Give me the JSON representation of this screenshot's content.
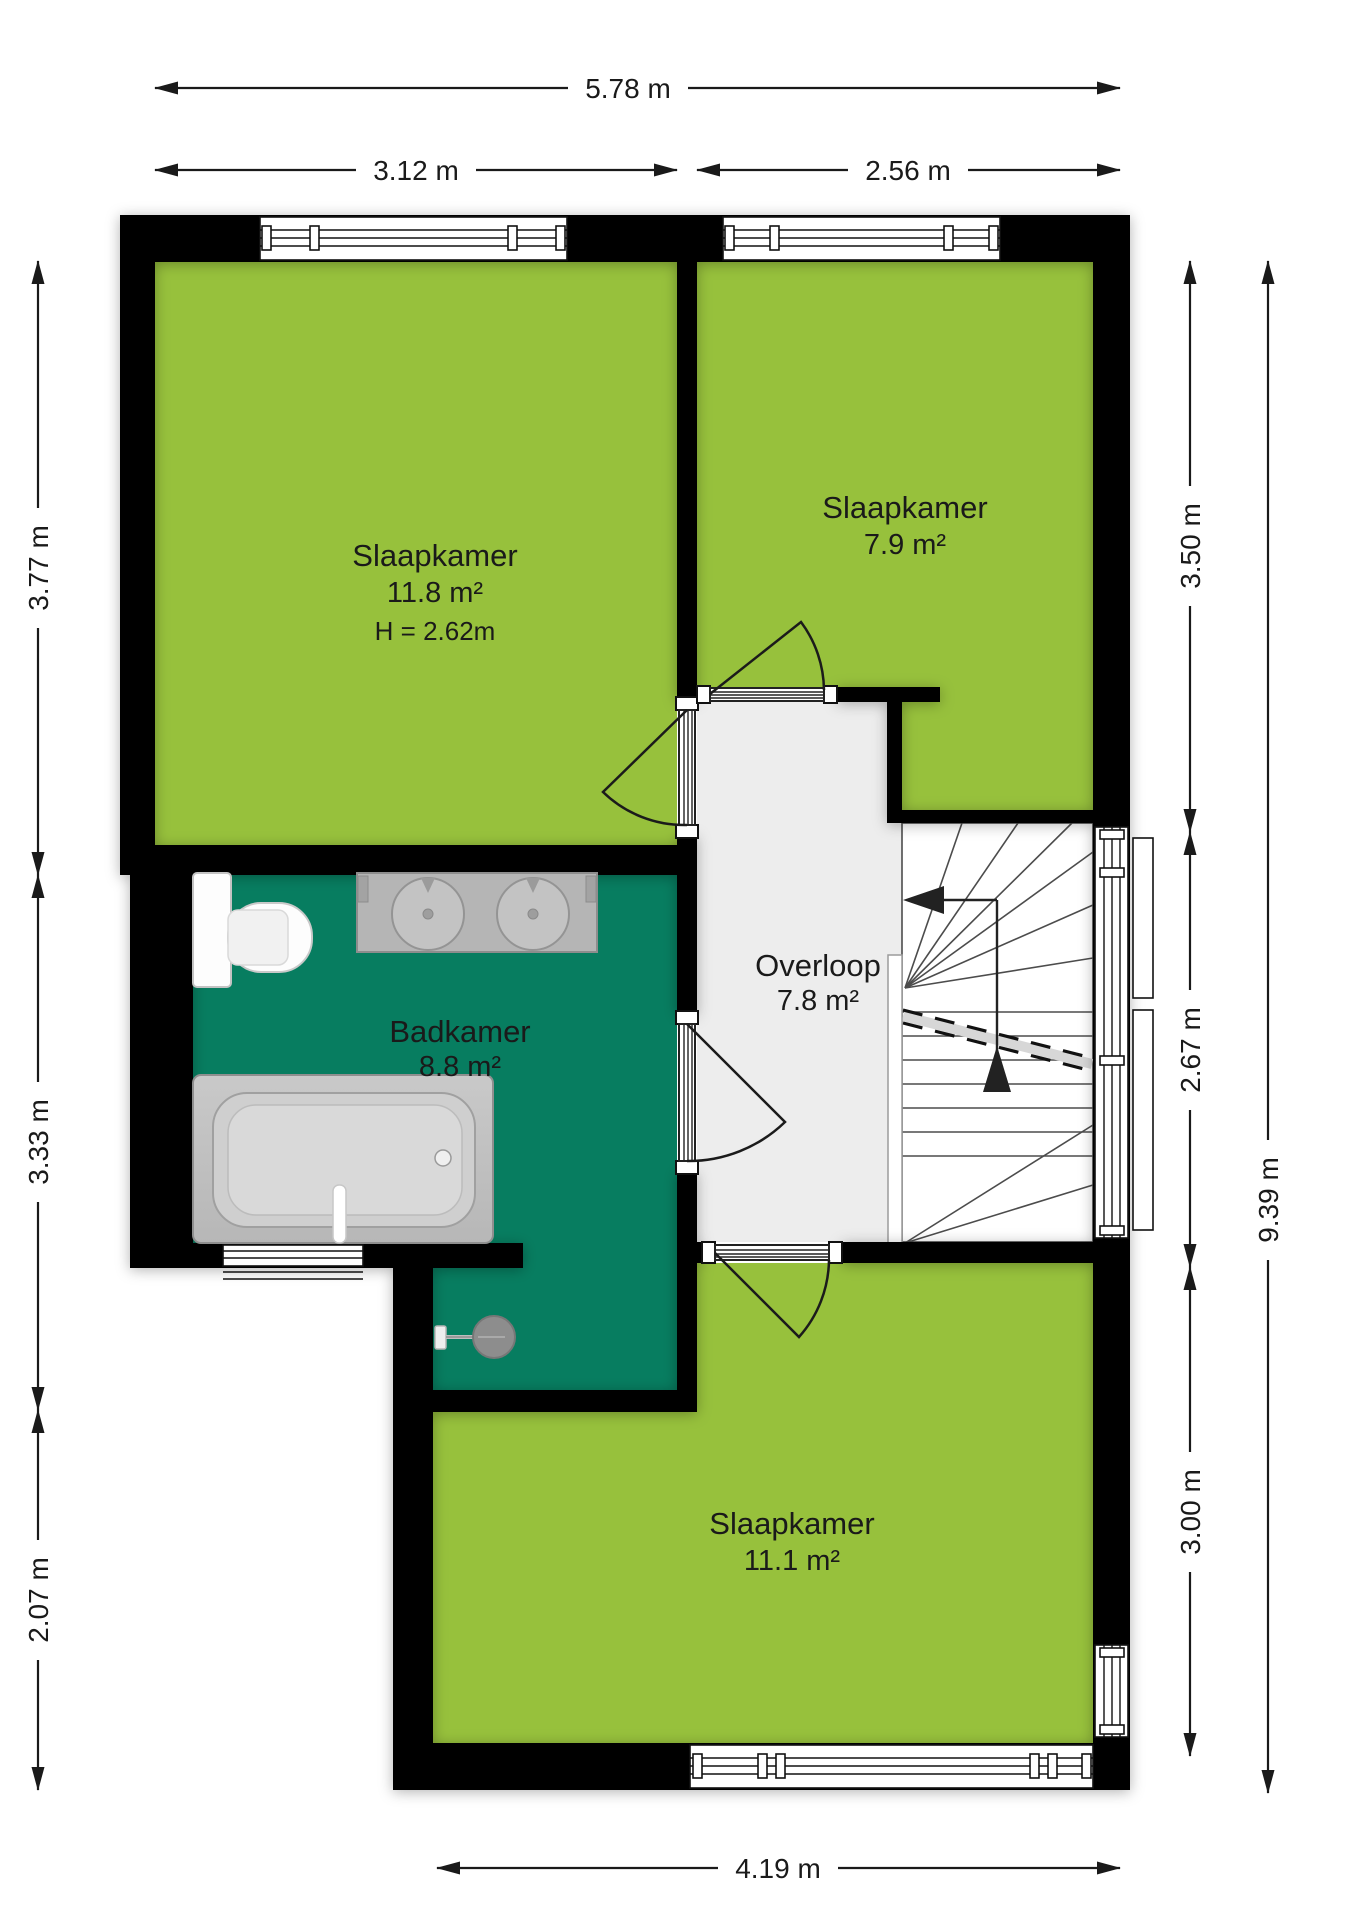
{
  "plan": {
    "title": "floorplan-first-floor",
    "rooms": [
      {
        "id": "slaapkamer-1",
        "name": "Slaapkamer",
        "area": "11.8 m²",
        "height_note": "H = 2.62m"
      },
      {
        "id": "slaapkamer-2",
        "name": "Slaapkamer",
        "area": "7.9 m²"
      },
      {
        "id": "badkamer",
        "name": "Badkamer",
        "area": "8.8 m²"
      },
      {
        "id": "overloop",
        "name": "Overloop",
        "area": "7.8 m²"
      },
      {
        "id": "slaapkamer-3",
        "name": "Slaapkamer",
        "area": "11.1 m²"
      }
    ],
    "dimensions": {
      "top_total": "5.78 m",
      "top_left": "3.12 m",
      "top_right": "2.56 m",
      "left_top": "3.77 m",
      "left_middle": "3.33 m",
      "left_bottom": "2.07 m",
      "right_top": "3.50 m",
      "right_middle": "2.67 m",
      "right_bottom": "3.00 m",
      "right_total": "9.39 m",
      "bottom": "4.19 m"
    },
    "colors": {
      "room_green": "#97c13c",
      "bathroom_teal": "#077d60",
      "landing_gray": "#ededed",
      "wall_black": "#050505",
      "fixture_gray": "#b5b5b5"
    }
  }
}
